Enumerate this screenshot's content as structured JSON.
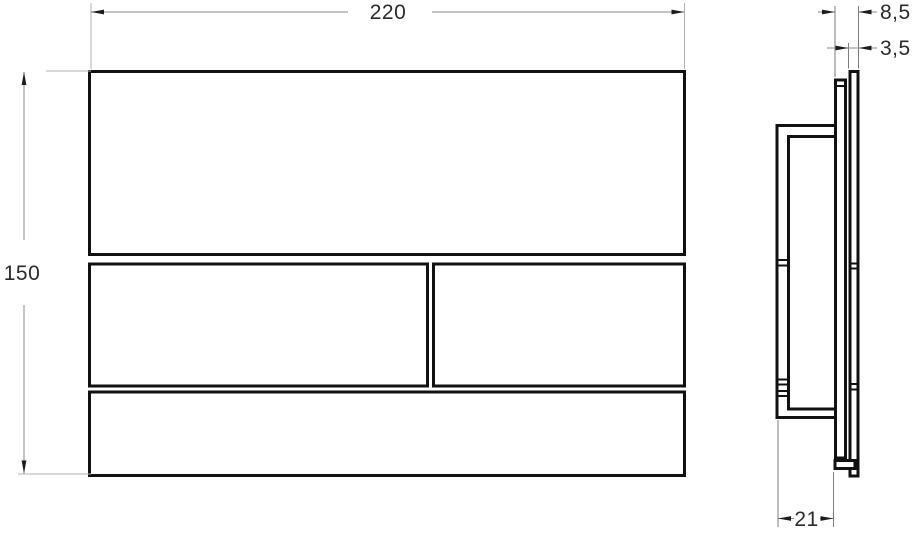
{
  "drawing": {
    "dimensions": {
      "width": "220",
      "height": "150",
      "total_depth": "8,5",
      "plate_thickness": "3,5",
      "frame_depth": "21"
    },
    "colors": {
      "part_line": "#111111",
      "dimension_line": "#8a8a8a",
      "extension_line": "#b2b2b2",
      "arrowhead": "#1c1c1c",
      "label_text": "#2b2b2b",
      "background": "#ffffff"
    }
  }
}
